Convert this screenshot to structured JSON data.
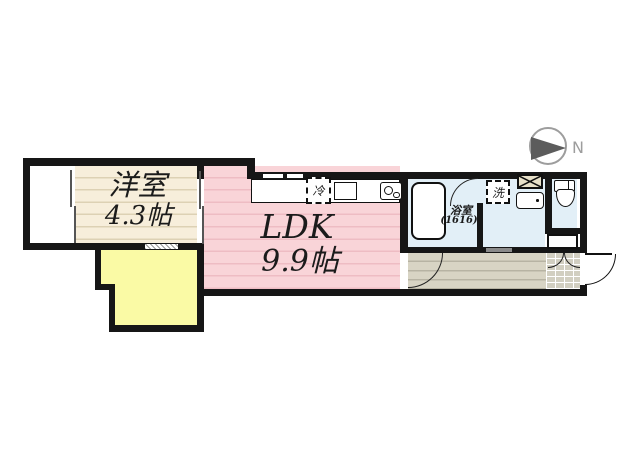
{
  "compass": {
    "north_label": "N"
  },
  "rooms": {
    "western_room": {
      "label": "洋室",
      "size": "4.3帖"
    },
    "ldk": {
      "label": "LDK",
      "size": "9.9帖"
    },
    "bathroom": {
      "label": "浴室",
      "size_note": "(1616)"
    }
  },
  "fixtures": {
    "refrigerator_label": "冷",
    "washing_machine_label": "洗"
  },
  "colors": {
    "wall": "#161616",
    "western_room_fill": "#f7eedb",
    "ldk_fill": "#f9d4d8",
    "wet_area_fill": "#e2eff7",
    "service_area_fill": "#fafaa5",
    "hallway_fill": "#d8d4c4",
    "compass_gray": "#9d9d9d"
  }
}
